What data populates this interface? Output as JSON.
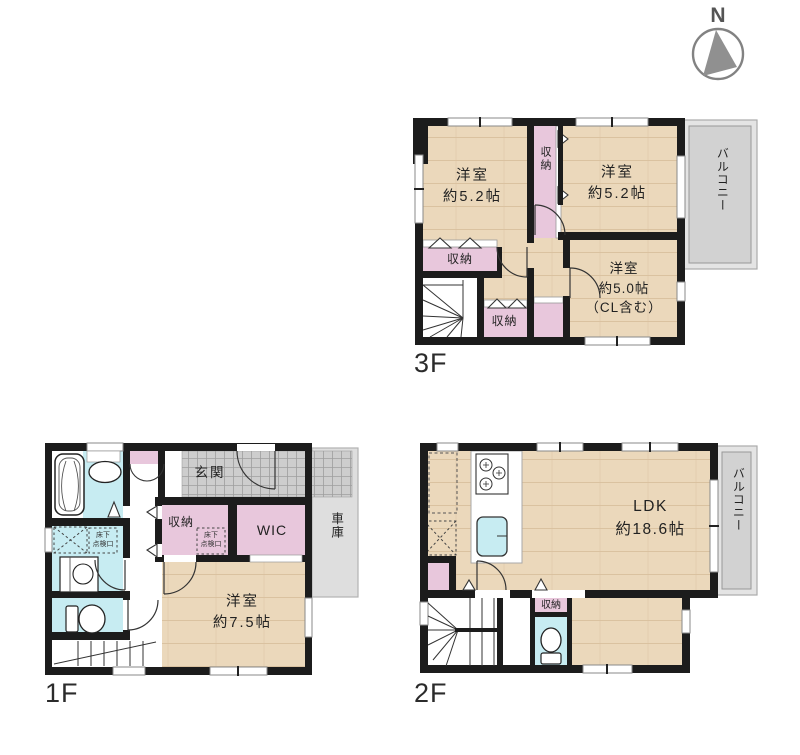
{
  "palette": {
    "wall": "#1c1c1c",
    "wood_floor": "#ebd8bb",
    "closet_pink": "#e8c7dc",
    "water_cyan": "#c7ecf2",
    "balcony_gray": "#d2d2d2",
    "entrance_tile": "#cdcdcd",
    "garage_gray": "#dedede"
  },
  "compass": {
    "north_label": "N"
  },
  "floor3": {
    "floor_label": "3F",
    "bedroom_left": {
      "name": "洋室",
      "size": "約5.2帖"
    },
    "bedroom_right": {
      "name": "洋室",
      "size": "約5.2帖"
    },
    "bedroom_back": {
      "name": "洋室",
      "size": "約5.0帖",
      "note": "（CL含む）"
    },
    "closet_mid": "収納",
    "closet_left": "収納",
    "closet_bottom": "収納",
    "balcony": "バルコニー"
  },
  "floor2": {
    "floor_label": "2F",
    "ldk": {
      "name": "LDK",
      "size": "約18.6帖"
    },
    "closet": "収納",
    "balcony": "バルコニー"
  },
  "floor1": {
    "floor_label": "1F",
    "entrance": "玄関",
    "closet": "収納",
    "wic": "WIC",
    "garage": "車庫",
    "bedroom": {
      "name": "洋室",
      "size": "約7.5帖"
    },
    "hatch_front": {
      "line1": "床下",
      "line2": "点検口"
    },
    "hatch_side": {
      "line1": "床下",
      "line2": "点検口"
    }
  }
}
